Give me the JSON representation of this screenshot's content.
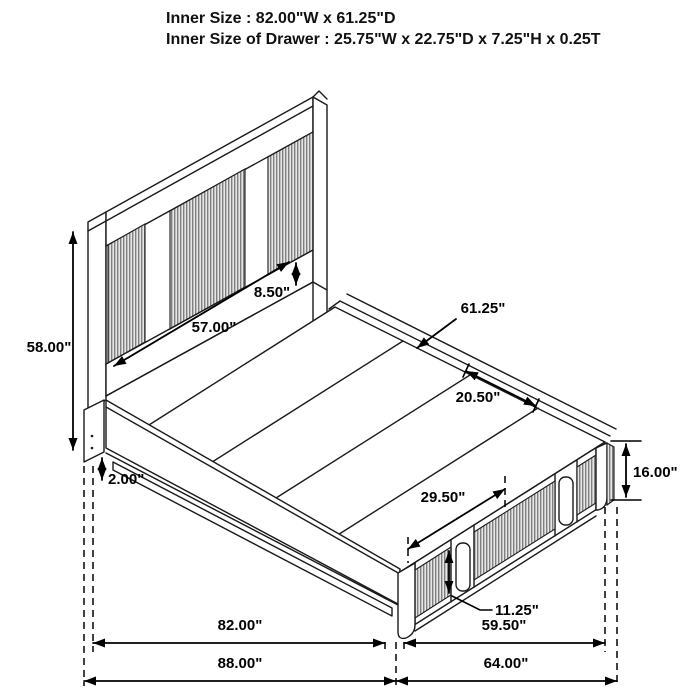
{
  "title_block": {
    "line1": "Inner Size : 82.00\"W x 61.25\"D",
    "line2": "Inner Size of Drawer : 25.75\"W x 22.75\"D x 7.25\"H x 0.25T"
  },
  "diagram": {
    "subject": "isometric line drawing of a platform storage bed with slatted headboard and footboard drawers",
    "dims": {
      "headboard_height": "58.00\"",
      "headboard_panel_width": "57.00\"",
      "headboard_bottom_rail": "8.50\"",
      "deck_depth": "61.25\"",
      "deck_panel": "20.50\"",
      "base_clearance": "2.00\"",
      "drawer_width": "29.50\"",
      "footboard_height": "16.00\"",
      "handle_height": "11.25\"",
      "inner_length": "82.00\"",
      "overall_length": "88.00\"",
      "foot_inner_width": "59.50\"",
      "foot_overall_width": "64.00\""
    },
    "colors": {
      "line": "#1a1a1a",
      "slat_stripe": "#808080",
      "slat_background": "#e6e6e6",
      "background": "#ffffff"
    }
  }
}
